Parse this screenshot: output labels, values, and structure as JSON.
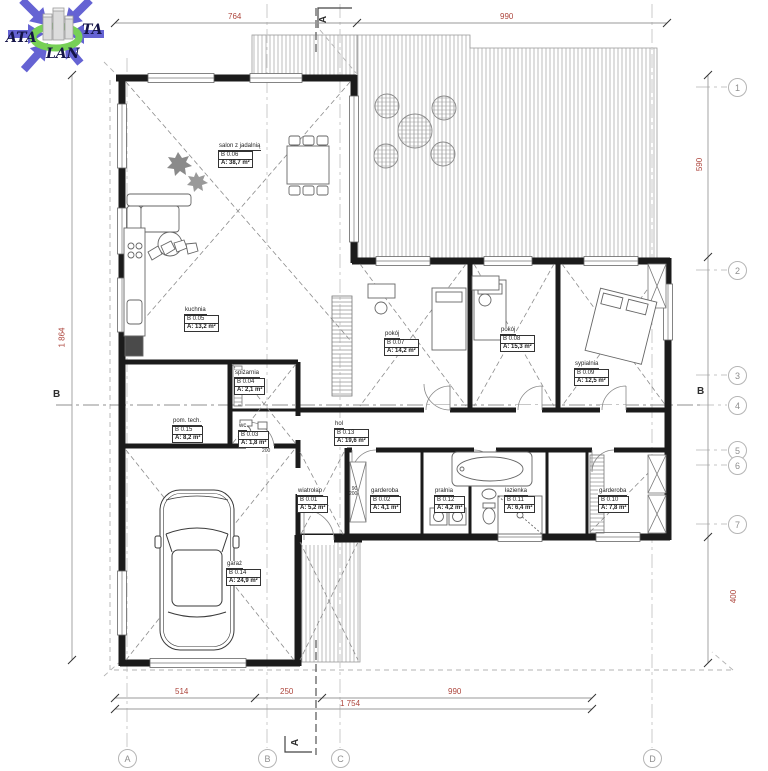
{
  "logo": {
    "left": "ATA",
    "right": "TA",
    "bottom": "LAN"
  },
  "grid": {
    "rows": [
      "1",
      "2",
      "3",
      "4",
      "5",
      "6",
      "7"
    ],
    "cols": [
      "A",
      "B",
      "C",
      "D"
    ]
  },
  "sections": {
    "vertical": "A",
    "horizontal": "B"
  },
  "dimensions": {
    "top": [
      "764",
      "990"
    ],
    "bottom": [
      "514",
      "250",
      "990"
    ],
    "bottom_total": "1 754",
    "left_total": "1 864",
    "right_upper": "590",
    "right_lower": "400",
    "door_annotations": [
      "90",
      "200",
      "200"
    ]
  },
  "rooms": [
    {
      "name": "salon z jadalnią",
      "number": "B 0.06",
      "area": "A: 38,7 m²"
    },
    {
      "name": "kuchnia",
      "number": "B 0.05",
      "area": "A: 13,2 m²"
    },
    {
      "name": "spiżarnia",
      "number": "B 0.04",
      "area": "A: 2,1 m²"
    },
    {
      "name": "wc",
      "number": "B 0.03",
      "area": "A: 1,8 m²"
    },
    {
      "name": "pom. tech.",
      "number": "B 0.15",
      "area": "A: 8,2 m²"
    },
    {
      "name": "hol",
      "number": "B 0.13",
      "area": "A: 19,6 m²"
    },
    {
      "name": "pokój",
      "number": "B 0.07",
      "area": "A: 14,2 m²"
    },
    {
      "name": "pokój",
      "number": "B 0.08",
      "area": "A: 15,3 m²"
    },
    {
      "name": "sypialnia",
      "number": "B 0.09",
      "area": "A: 12,5 m²"
    },
    {
      "name": "wiatrołap",
      "number": "B 0.01",
      "area": "A: 5,2 m²"
    },
    {
      "name": "garderoba",
      "number": "B 0.02",
      "area": "A: 4,1 m²"
    },
    {
      "name": "pralnia",
      "number": "B 0.12",
      "area": "A: 4,2 m²"
    },
    {
      "name": "łazienka",
      "number": "B 0.11",
      "area": "A: 6,4 m²"
    },
    {
      "name": "garderoba",
      "number": "B 0.10",
      "area": "A: 7,8 m²"
    },
    {
      "name": "garaż",
      "number": "B 0.14",
      "area": "A: 24,9 m²"
    }
  ],
  "colors": {
    "dimension_red": "#ad453c",
    "wall_black": "#1b1b1b",
    "grid_gray": "#b5b5b5",
    "logo_blue": "#5553cf",
    "logo_green": "#69cc44"
  }
}
